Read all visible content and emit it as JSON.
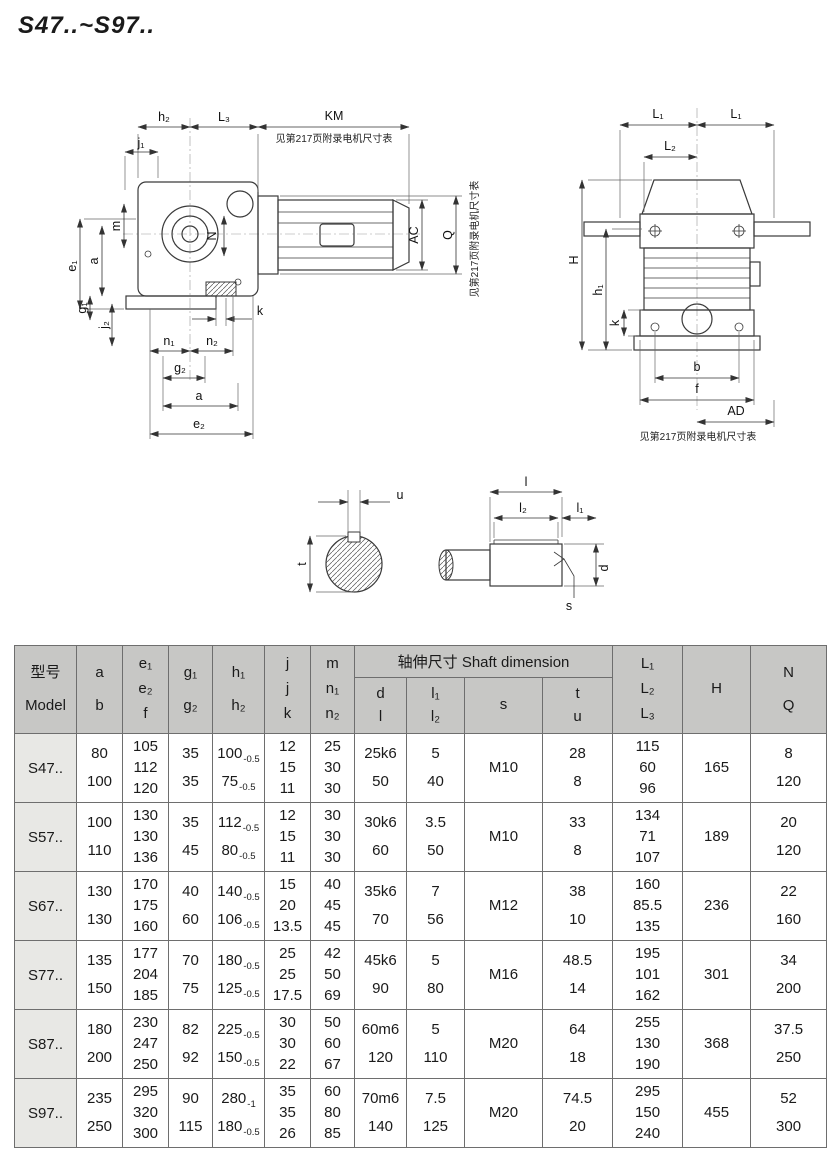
{
  "title": "S47..~S97..",
  "notes": {
    "motor_table": "见第217页附录电机尺寸表"
  },
  "colors": {
    "header_bg": "#c7c7c5",
    "model_bg": "#e8e8e5",
    "border": "#6e6e6e",
    "line": "#3a3a3a"
  },
  "dims": {
    "h2": "h₂",
    "L3": "L₃",
    "KM": "KM",
    "j1": "j₁",
    "m": "m",
    "N": "N",
    "e1": "e₁",
    "a": "a",
    "g1": "g₁",
    "j2": "j₂",
    "k": "k",
    "n1": "n₁",
    "n2": "n₂",
    "g2": "g₂",
    "e2": "e₂",
    "AC": "AC",
    "Q": "Q",
    "L1": "L₁",
    "L2": "L₂",
    "H": "H",
    "h1": "h₁",
    "b": "b",
    "f": "f",
    "AD": "AD",
    "u": "u",
    "t": "t",
    "l": "l",
    "l1": "l₁",
    "l2": "l₂",
    "d": "d",
    "s": "s"
  },
  "table": {
    "group_header": "轴伸尺寸 Shaft dimension",
    "headers": {
      "model": [
        "型号",
        "Model"
      ],
      "ab": [
        "a",
        "b"
      ],
      "ef": [
        "e₁",
        "e₂",
        "f"
      ],
      "g": [
        "g₁",
        "g₂"
      ],
      "h": [
        "h₁",
        "h₂"
      ],
      "jk": [
        "j",
        "j",
        "k"
      ],
      "mn": [
        "m",
        "n₁",
        "n₂"
      ],
      "dl": [
        "d",
        "l"
      ],
      "l12": [
        "l₁",
        "l₂"
      ],
      "s": "s",
      "tu": [
        "t",
        "u"
      ],
      "L": [
        "L₁",
        "L₂",
        "L₃"
      ],
      "H": "H",
      "NQ": [
        "N",
        "Q"
      ]
    },
    "rows": [
      {
        "model": "S47..",
        "ab": [
          "80",
          "100"
        ],
        "ef": [
          "105",
          "112",
          "120"
        ],
        "g": [
          "35",
          "35"
        ],
        "h": [
          [
            "100",
            "-0.5"
          ],
          [
            "75",
            "-0.5"
          ]
        ],
        "jk": [
          "12",
          "15",
          "11"
        ],
        "mn": [
          "25",
          "30",
          "30"
        ],
        "dl": [
          "25k6",
          "50"
        ],
        "l12": [
          "5",
          "40"
        ],
        "s": "M10",
        "tu": [
          "28",
          "8"
        ],
        "L": [
          "115",
          "60",
          "96"
        ],
        "H": "165",
        "NQ": [
          "8",
          "120"
        ]
      },
      {
        "model": "S57..",
        "ab": [
          "100",
          "110"
        ],
        "ef": [
          "130",
          "130",
          "136"
        ],
        "g": [
          "35",
          "45"
        ],
        "h": [
          [
            "112",
            "-0.5"
          ],
          [
            "80",
            "-0.5"
          ]
        ],
        "jk": [
          "12",
          "15",
          "11"
        ],
        "mn": [
          "30",
          "30",
          "30"
        ],
        "dl": [
          "30k6",
          "60"
        ],
        "l12": [
          "3.5",
          "50"
        ],
        "s": "M10",
        "tu": [
          "33",
          "8"
        ],
        "L": [
          "134",
          "71",
          "107"
        ],
        "H": "189",
        "NQ": [
          "20",
          "120"
        ]
      },
      {
        "model": "S67..",
        "ab": [
          "130",
          "130"
        ],
        "ef": [
          "170",
          "175",
          "160"
        ],
        "g": [
          "40",
          "60"
        ],
        "h": [
          [
            "140",
            "-0.5"
          ],
          [
            "106",
            "-0.5"
          ]
        ],
        "jk": [
          "15",
          "20",
          "13.5"
        ],
        "mn": [
          "40",
          "45",
          "45"
        ],
        "dl": [
          "35k6",
          "70"
        ],
        "l12": [
          "7",
          "56"
        ],
        "s": "M12",
        "tu": [
          "38",
          "10"
        ],
        "L": [
          "160",
          "85.5",
          "135"
        ],
        "H": "236",
        "NQ": [
          "22",
          "160"
        ]
      },
      {
        "model": "S77..",
        "ab": [
          "135",
          "150"
        ],
        "ef": [
          "177",
          "204",
          "185"
        ],
        "g": [
          "70",
          "75"
        ],
        "h": [
          [
            "180",
            "-0.5"
          ],
          [
            "125",
            "-0.5"
          ]
        ],
        "jk": [
          "25",
          "25",
          "17.5"
        ],
        "mn": [
          "42",
          "50",
          "69"
        ],
        "dl": [
          "45k6",
          "90"
        ],
        "l12": [
          "5",
          "80"
        ],
        "s": "M16",
        "tu": [
          "48.5",
          "14"
        ],
        "L": [
          "195",
          "101",
          "162"
        ],
        "H": "301",
        "NQ": [
          "34",
          "200"
        ]
      },
      {
        "model": "S87..",
        "ab": [
          "180",
          "200"
        ],
        "ef": [
          "230",
          "247",
          "250"
        ],
        "g": [
          "82",
          "92"
        ],
        "h": [
          [
            "225",
            "-0.5"
          ],
          [
            "150",
            "-0.5"
          ]
        ],
        "jk": [
          "30",
          "30",
          "22"
        ],
        "mn": [
          "50",
          "60",
          "67"
        ],
        "dl": [
          "60m6",
          "120"
        ],
        "l12": [
          "5",
          "110"
        ],
        "s": "M20",
        "tu": [
          "64",
          "18"
        ],
        "L": [
          "255",
          "130",
          "190"
        ],
        "H": "368",
        "NQ": [
          "37.5",
          "250"
        ]
      },
      {
        "model": "S97..",
        "ab": [
          "235",
          "250"
        ],
        "ef": [
          "295",
          "320",
          "300"
        ],
        "g": [
          "90",
          "115"
        ],
        "h": [
          [
            "280",
            "-1"
          ],
          [
            "180",
            "-0.5"
          ]
        ],
        "jk": [
          "35",
          "35",
          "26"
        ],
        "mn": [
          "60",
          "80",
          "85"
        ],
        "dl": [
          "70m6",
          "140"
        ],
        "l12": [
          "7.5",
          "125"
        ],
        "s": "M20",
        "tu": [
          "74.5",
          "20"
        ],
        "L": [
          "295",
          "150",
          "240"
        ],
        "H": "455",
        "NQ": [
          "52",
          "300"
        ]
      }
    ]
  }
}
